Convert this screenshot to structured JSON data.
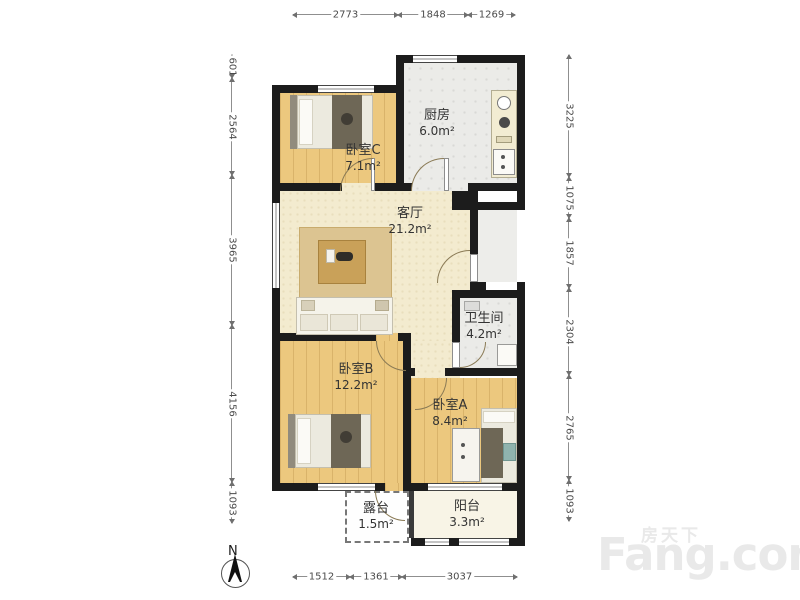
{
  "compass": {
    "label": "N"
  },
  "watermark": {
    "brand_cn": "房天下",
    "brand_en": "Fang.com"
  },
  "rooms": [
    {
      "name": "厨房",
      "area": "6.0m²"
    },
    {
      "name": "卧室C",
      "area": "7.1m²"
    },
    {
      "name": "客厅",
      "area": "21.2m²"
    },
    {
      "name": "卫生间",
      "area": "4.2m²"
    },
    {
      "name": "卧室B",
      "area": "12.2m²"
    },
    {
      "name": "卧室A",
      "area": "8.4m²"
    },
    {
      "name": "露台",
      "area": "1.5m²"
    },
    {
      "name": "阳台",
      "area": "3.3m²"
    }
  ],
  "dimensions_mm": {
    "top": [
      "2773",
      "1848",
      "1269"
    ],
    "bottom": [
      "1512",
      "1361",
      "3037"
    ],
    "left": [
      "601",
      "2564",
      "3965",
      "4156",
      "1093"
    ],
    "right": [
      "3225",
      "1075",
      "1857",
      "2304",
      "2765",
      "1093"
    ]
  },
  "dim_segments": [
    {
      "side": "top",
      "value": "2773",
      "x": 293,
      "y": 14,
      "len": 105
    },
    {
      "side": "top",
      "value": "1848",
      "x": 398,
      "y": 14,
      "len": 70
    },
    {
      "side": "top",
      "value": "1269",
      "x": 468,
      "y": 14,
      "len": 47
    },
    {
      "side": "bottom",
      "value": "1512",
      "x": 293,
      "y": 576,
      "len": 57
    },
    {
      "side": "bottom",
      "value": "1361",
      "x": 350,
      "y": 576,
      "len": 52
    },
    {
      "side": "bottom",
      "value": "3037",
      "x": 402,
      "y": 576,
      "len": 115
    },
    {
      "side": "left",
      "value": "601",
      "x": 231,
      "y": 55,
      "len": 23
    },
    {
      "side": "left",
      "value": "2564",
      "x": 231,
      "y": 78,
      "len": 97
    },
    {
      "side": "left",
      "value": "3965",
      "x": 231,
      "y": 175,
      "len": 150
    },
    {
      "side": "left",
      "value": "4156",
      "x": 231,
      "y": 325,
      "len": 157
    },
    {
      "side": "left",
      "value": "1093",
      "x": 231,
      "y": 482,
      "len": 41
    },
    {
      "side": "right",
      "value": "3225",
      "x": 568,
      "y": 55,
      "len": 122
    },
    {
      "side": "right",
      "value": "1075",
      "x": 568,
      "y": 177,
      "len": 41
    },
    {
      "side": "right",
      "value": "1857",
      "x": 568,
      "y": 218,
      "len": 70
    },
    {
      "side": "right",
      "value": "2304",
      "x": 568,
      "y": 288,
      "len": 87
    },
    {
      "side": "right",
      "value": "2765",
      "x": 568,
      "y": 375,
      "len": 105
    },
    {
      "side": "right",
      "value": "1093",
      "x": 568,
      "y": 480,
      "len": 41
    }
  ],
  "colors": {
    "wall": "#1c1c1c",
    "wood_floor": "#ecc87e",
    "tile_floor": "#ebebe8",
    "living_floor": "#f3ebcf",
    "balcony_floor": "#f8f4e6",
    "dim_text": "#4a4a4a",
    "label_text": "#333333",
    "watermark": "#e9e9e9"
  }
}
